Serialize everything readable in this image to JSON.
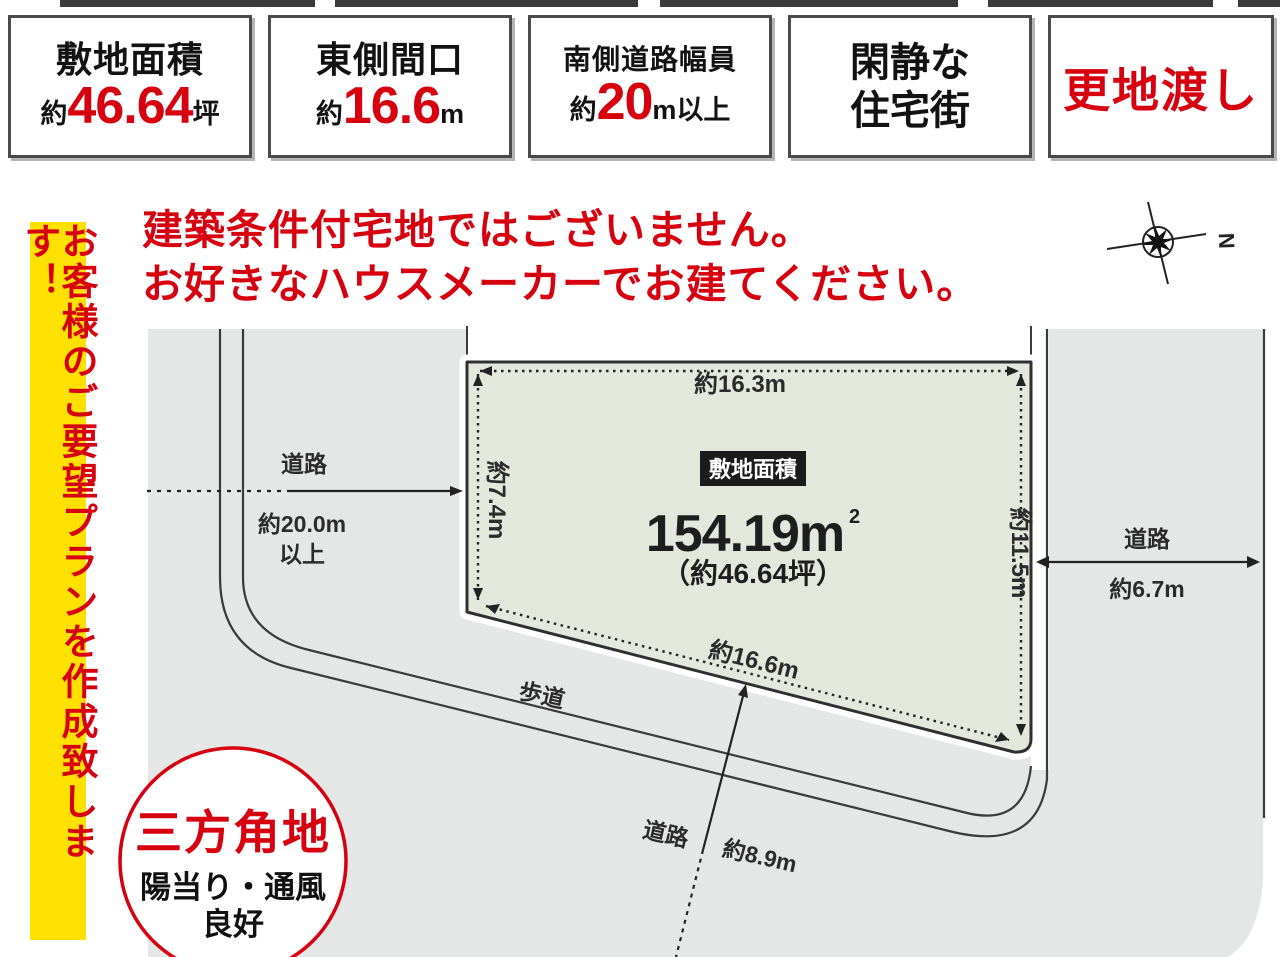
{
  "colors": {
    "accent_red": "#d7000f",
    "banner_yellow": "#ffe100",
    "plot_fill": "#e4e7db",
    "road_gray": "#e5e6e6",
    "badge_black": "#1b1b1b"
  },
  "info_boxes": {
    "box1": {
      "title": "敷地面積",
      "prefix": "約",
      "value": "46.64",
      "suffix": "坪"
    },
    "box2": {
      "title": "東側間口",
      "prefix": "約",
      "value": "16.6",
      "suffix": "m"
    },
    "box3": {
      "title": "南側道路幅員",
      "prefix": "約",
      "value": "20",
      "suffix": "m以上"
    },
    "box4": {
      "line1": "閑静な",
      "line2": "住宅街"
    },
    "box5": {
      "label": "更地渡し"
    }
  },
  "side_banner": {
    "text": "お客様のご要望プランを作成致します！"
  },
  "headline": {
    "line1": "建築条件付宅地ではございません。",
    "line2": "お好きなハウスメーカーでお建てください。"
  },
  "compass": {
    "north_label": "N"
  },
  "plot": {
    "badge": "敷地面積",
    "area": "154.19m",
    "area_sup": "2",
    "tsubo": "（約46.64坪）",
    "dim_top": "約16.3m",
    "dim_left": "約7.4m",
    "dim_right": "約11.5m",
    "dim_bottom": "約16.6m"
  },
  "roads": {
    "west": {
      "label": "道路",
      "width_line1": "約20.0m",
      "width_line2": "以上"
    },
    "east": {
      "label": "道路",
      "width": "約6.7m"
    },
    "south": {
      "sidewalk": "歩道",
      "label": "道路",
      "width": "約8.9m"
    }
  },
  "corner_badge": {
    "title": "三方角地",
    "sub_line1": "陽当り・通風",
    "sub_line2": "良好"
  }
}
